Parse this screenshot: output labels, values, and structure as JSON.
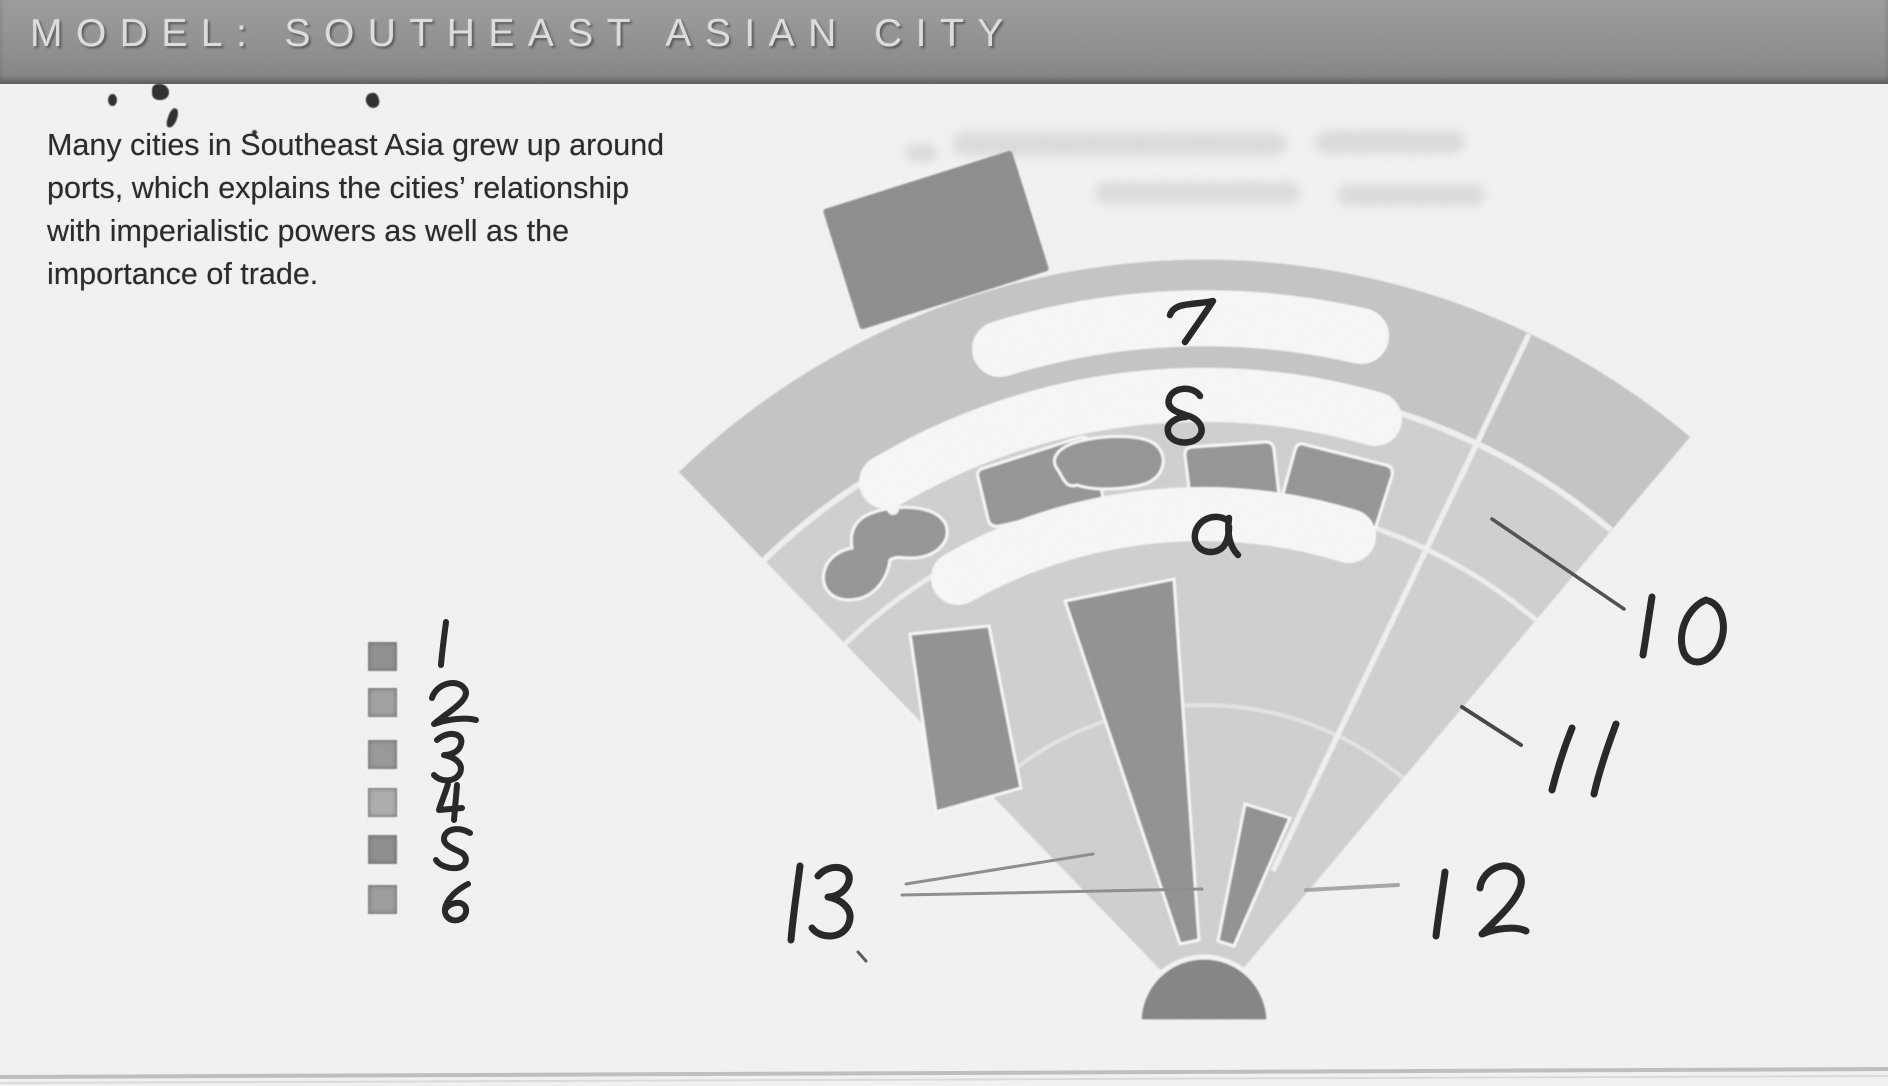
{
  "header": {
    "title": "MODEL: SOUTHEAST ASIAN CITY"
  },
  "intro": {
    "lines": [
      "Many cities in Southeast Asia grew up around",
      "ports, which explains the cities’ relationship",
      "with imperialistic powers as well as the",
      "importance of trade."
    ]
  },
  "legend": {
    "items": [
      {
        "number": "1",
        "swatch_color": "#8f8f8f"
      },
      {
        "number": "2",
        "swatch_color": "#a1a1a1"
      },
      {
        "number": "3",
        "swatch_color": "#989898"
      },
      {
        "number": "4",
        "swatch_color": "#aeaeae"
      },
      {
        "number": "5",
        "swatch_color": "#8c8c8c"
      },
      {
        "number": "6",
        "swatch_color": "#9d9d9d"
      }
    ]
  },
  "diagram": {
    "model_name": "Southeast Asian city fan model",
    "handwritten_answers": [
      {
        "value": "7",
        "zone": "outer ring (whited-out label)"
      },
      {
        "value": "8",
        "zone": "second ring (whited-out label)"
      },
      {
        "value": "a",
        "zone": "third ring (whited-out label)"
      },
      {
        "value": "10",
        "zone": "right sector outer band"
      },
      {
        "value": "11",
        "zone": "right sector middle band"
      },
      {
        "value": "12",
        "zone": "right sector inner band"
      },
      {
        "value": "13",
        "zone": "central dark wedge"
      }
    ],
    "colors": {
      "page": "#fafafa",
      "header_bar": "#8d8d8d",
      "header_text": "#e3e3e3",
      "fan_base": "#d4d4d4",
      "fan_outer_band": "#c8c8c8",
      "dark_zone": "#929292",
      "blob": "#959595",
      "port": "#8c8c8c",
      "apex_semicircle": "#838383",
      "ink": "#1a1a1a"
    }
  }
}
